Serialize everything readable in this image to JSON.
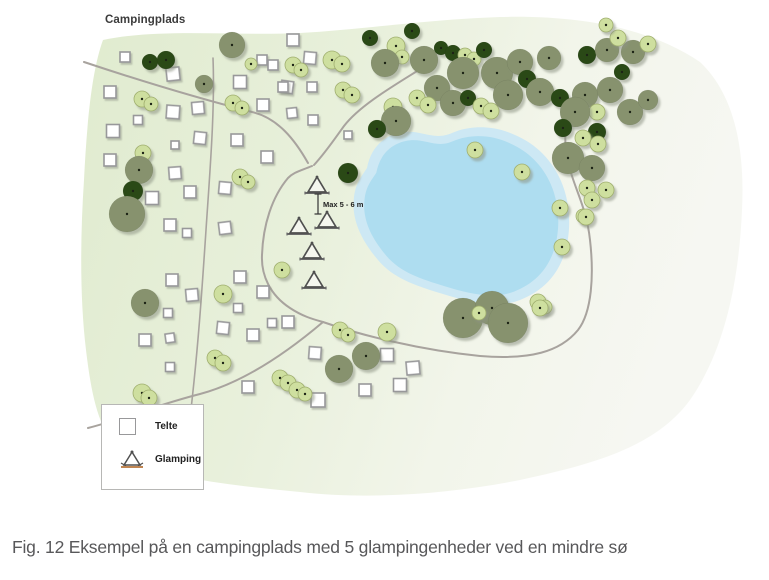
{
  "figure": {
    "map_label": "Campingplads",
    "annotation": "Max 5 - 6 m",
    "caption": "Fig. 12 Eksempel på en campingplads med 5 glampingenheder ved en mindre sø"
  },
  "legend": {
    "items": [
      {
        "symbol": "tent-square",
        "label": "Telte"
      },
      {
        "symbol": "glamping-triangle",
        "label": "Glamping"
      }
    ]
  },
  "colors": {
    "page_bg": "#ffffff",
    "terrain_green": "#e0ebcf",
    "terrain_mid": "#e8f0db",
    "terrain_pale": "#f2f5ea",
    "terrain_white": "#f6f7f2",
    "lake_outer": "#cde8f4",
    "lake_inner": "#aeddf0",
    "road": "#a8a39e",
    "tent_fill": "#ffffff",
    "tent_stroke": "#98989a",
    "tree_dark": "#2c4a17",
    "tree_olive": "#87926e",
    "tree_light": "#cedf9f",
    "tree_light_stroke": "#9fae6e",
    "tree_dot": "#1d2412",
    "glamping_stroke": "#4f4f4f",
    "glamping_base": "#6a6a6a",
    "glamping_base_legend": "#c08552",
    "dimension": "#333333",
    "shadow": "#8d9384"
  },
  "terrain": {
    "outline": "M 103,40 C 160,28 230,36 300,33 C 360,30 420,20 500,17 C 580,15 650,28 700,62 C 735,95 745,150 742,210 C 739,280 725,350 690,400 C 655,448 590,465 520,480 C 450,494 370,500 300,492 C 240,486 170,480 130,458 C 100,440 92,400 86,350 C 80,300 80,240 84,180 C 87,120 92,70 103,40 Z"
  },
  "lake": {
    "outline": "M 367,168 C 371,146 386,134 404,132 C 422,130 434,141 452,133 C 470,125 494,125 515,135 C 536,144 552,160 561,181 C 570,202 572,228 565,252 C 558,275 543,291 520,300 C 497,309 469,302 443,294 C 417,286 394,279 378,260 C 362,241 351,220 354,197 C 356,182 362,176 367,168 Z",
    "inner_scale": 0.9,
    "center": [
      460,
      216
    ]
  },
  "roads": [
    {
      "d": "M 84,62 C 150,84 205,100 252,112 C 278,118 295,140 308,163",
      "w": 2
    },
    {
      "d": "M 422,68 C 395,85 360,105 344,126 C 336,137 326,152 314,165",
      "w": 2
    },
    {
      "d": "M 312,166 C 300,171 294,172 288,178 C 272,197 263,225 262,255 C 261,275 270,295 290,308 C 302,316 312,319 323,322",
      "w": 2
    },
    {
      "d": "M 213,58 C 215,110 210,170 206,230 C 202,290 198,350 190,418",
      "w": 1.6
    },
    {
      "d": "M 88,428 C 120,420 160,404 200,394 C 245,382 290,350 323,322",
      "w": 2
    },
    {
      "d": "M 323,322 C 360,335 420,350 480,356 C 530,360 560,352 578,330 C 592,312 594,275 590,240 C 587,212 578,195 572,176 C 566,158 564,143 566,128",
      "w": 2
    }
  ],
  "tents": [
    [
      125,
      57,
      10,
      0
    ],
    [
      262,
      60,
      10,
      0
    ],
    [
      173,
      74,
      13,
      -6
    ],
    [
      240,
      82,
      13,
      0
    ],
    [
      287,
      87,
      12,
      8
    ],
    [
      110,
      92,
      12,
      0
    ],
    [
      198,
      108,
      12,
      -5
    ],
    [
      263,
      105,
      12,
      0
    ],
    [
      173,
      112,
      13,
      4
    ],
    [
      313,
      120,
      10,
      0
    ],
    [
      138,
      120,
      9,
      0
    ],
    [
      113,
      131,
      13,
      0
    ],
    [
      200,
      138,
      12,
      6
    ],
    [
      237,
      140,
      12,
      0
    ],
    [
      292,
      113,
      10,
      -6
    ],
    [
      110,
      160,
      12,
      0
    ],
    [
      267,
      157,
      12,
      0
    ],
    [
      175,
      145,
      8,
      0
    ],
    [
      175,
      173,
      12,
      -4
    ],
    [
      152,
      198,
      13,
      0
    ],
    [
      190,
      192,
      12,
      0
    ],
    [
      225,
      188,
      12,
      5
    ],
    [
      170,
      225,
      12,
      0
    ],
    [
      187,
      233,
      9,
      0
    ],
    [
      225,
      228,
      12,
      -7
    ],
    [
      293,
      40,
      12,
      0
    ],
    [
      310,
      58,
      12,
      5
    ],
    [
      273,
      65,
      10,
      0
    ],
    [
      283,
      87,
      10,
      0
    ],
    [
      312,
      87,
      10,
      0
    ],
    [
      348,
      135,
      8,
      0
    ],
    [
      172,
      280,
      12,
      0
    ],
    [
      192,
      295,
      12,
      -5
    ],
    [
      240,
      277,
      12,
      0
    ],
    [
      263,
      292,
      12,
      0
    ],
    [
      238,
      308,
      9,
      0
    ],
    [
      223,
      328,
      12,
      6
    ],
    [
      253,
      335,
      12,
      0
    ],
    [
      272,
      323,
      9,
      0
    ],
    [
      288,
      322,
      12,
      0
    ],
    [
      168,
      313,
      9,
      0
    ],
    [
      145,
      340,
      12,
      0
    ],
    [
      170,
      338,
      9,
      -8
    ],
    [
      170,
      367,
      9,
      0
    ],
    [
      248,
      387,
      12,
      0
    ],
    [
      315,
      353,
      12,
      4
    ],
    [
      365,
      390,
      12,
      0
    ],
    [
      400,
      385,
      13,
      0
    ],
    [
      413,
      368,
      13,
      -5
    ],
    [
      387,
      355,
      13,
      0
    ],
    [
      318,
      400,
      14,
      0
    ]
  ],
  "trees": [
    [
      150,
      62,
      8,
      "d"
    ],
    [
      166,
      60,
      9,
      "d"
    ],
    [
      232,
      45,
      13,
      "o"
    ],
    [
      251,
      64,
      6,
      "l"
    ],
    [
      204,
      84,
      9,
      "o"
    ],
    [
      142,
      99,
      8,
      "l"
    ],
    [
      151,
      104,
      7,
      "l"
    ],
    [
      233,
      103,
      8,
      "l"
    ],
    [
      242,
      108,
      7,
      "l"
    ],
    [
      293,
      65,
      8,
      "l"
    ],
    [
      301,
      70,
      7,
      "l"
    ],
    [
      143,
      153,
      8,
      "l"
    ],
    [
      139,
      170,
      14,
      "o"
    ],
    [
      133,
      191,
      10,
      "d"
    ],
    [
      127,
      214,
      18,
      "o"
    ],
    [
      145,
      303,
      14,
      "o"
    ],
    [
      223,
      294,
      9,
      "l"
    ],
    [
      282,
      270,
      8,
      "l"
    ],
    [
      240,
      177,
      8,
      "l"
    ],
    [
      248,
      182,
      7,
      "l"
    ],
    [
      215,
      358,
      8,
      "l"
    ],
    [
      223,
      363,
      8,
      "l"
    ],
    [
      280,
      378,
      8,
      "l"
    ],
    [
      288,
      383,
      8,
      "l"
    ],
    [
      297,
      390,
      8,
      "l"
    ],
    [
      305,
      394,
      7,
      "l"
    ],
    [
      142,
      393,
      9,
      "l"
    ],
    [
      149,
      398,
      8,
      "l"
    ],
    [
      340,
      330,
      8,
      "l"
    ],
    [
      348,
      335,
      7,
      "l"
    ],
    [
      387,
      332,
      9,
      "l"
    ],
    [
      339,
      369,
      14,
      "o"
    ],
    [
      366,
      356,
      14,
      "o"
    ],
    [
      393,
      107,
      9,
      "l"
    ],
    [
      396,
      121,
      15,
      "o"
    ],
    [
      377,
      129,
      9,
      "d"
    ],
    [
      348,
      173,
      10,
      "d"
    ],
    [
      475,
      150,
      8,
      "l"
    ],
    [
      522,
      172,
      8,
      "l"
    ],
    [
      560,
      208,
      8,
      "l"
    ],
    [
      583,
      216,
      7,
      "l"
    ],
    [
      562,
      247,
      8,
      "l"
    ],
    [
      538,
      302,
      8,
      "l"
    ],
    [
      545,
      307,
      7,
      "l"
    ],
    [
      463,
      318,
      20,
      "o"
    ],
    [
      492,
      308,
      17,
      "o"
    ],
    [
      508,
      323,
      20,
      "o"
    ],
    [
      479,
      313,
      7,
      "l"
    ],
    [
      540,
      308,
      8,
      "l"
    ],
    [
      332,
      60,
      9,
      "l"
    ],
    [
      342,
      64,
      8,
      "l"
    ],
    [
      343,
      90,
      8,
      "l"
    ],
    [
      352,
      95,
      8,
      "l"
    ],
    [
      370,
      38,
      8,
      "d"
    ],
    [
      412,
      31,
      8,
      "d"
    ],
    [
      396,
      46,
      9,
      "l"
    ],
    [
      402,
      57,
      7,
      "l"
    ],
    [
      385,
      63,
      14,
      "o"
    ],
    [
      424,
      60,
      14,
      "o"
    ],
    [
      441,
      48,
      7,
      "d"
    ],
    [
      453,
      53,
      8,
      "d"
    ],
    [
      465,
      55,
      7,
      "l"
    ],
    [
      474,
      59,
      7,
      "l"
    ],
    [
      484,
      50,
      8,
      "d"
    ],
    [
      497,
      73,
      16,
      "o"
    ],
    [
      520,
      62,
      13,
      "o"
    ],
    [
      527,
      79,
      9,
      "d"
    ],
    [
      549,
      58,
      12,
      "o"
    ],
    [
      587,
      55,
      9,
      "d"
    ],
    [
      607,
      50,
      12,
      "o"
    ],
    [
      633,
      52,
      12,
      "o"
    ],
    [
      618,
      38,
      8,
      "l"
    ],
    [
      606,
      25,
      7,
      "l"
    ],
    [
      648,
      44,
      8,
      "l"
    ],
    [
      463,
      73,
      16,
      "o"
    ],
    [
      437,
      88,
      13,
      "o"
    ],
    [
      417,
      98,
      8,
      "l"
    ],
    [
      428,
      105,
      8,
      "l"
    ],
    [
      453,
      103,
      13,
      "o"
    ],
    [
      468,
      98,
      8,
      "d"
    ],
    [
      481,
      106,
      8,
      "l"
    ],
    [
      491,
      111,
      8,
      "l"
    ],
    [
      508,
      95,
      15,
      "o"
    ],
    [
      540,
      92,
      14,
      "o"
    ],
    [
      560,
      98,
      9,
      "d"
    ],
    [
      585,
      95,
      13,
      "o"
    ],
    [
      610,
      90,
      13,
      "o"
    ],
    [
      597,
      112,
      8,
      "l"
    ],
    [
      630,
      112,
      13,
      "o"
    ],
    [
      648,
      100,
      10,
      "o"
    ],
    [
      622,
      72,
      8,
      "d"
    ],
    [
      575,
      112,
      15,
      "o"
    ],
    [
      563,
      128,
      9,
      "d"
    ],
    [
      597,
      132,
      9,
      "d"
    ],
    [
      583,
      138,
      8,
      "l"
    ],
    [
      598,
      144,
      8,
      "l"
    ],
    [
      568,
      158,
      16,
      "o"
    ],
    [
      592,
      168,
      13,
      "o"
    ],
    [
      587,
      188,
      8,
      "l"
    ],
    [
      606,
      190,
      8,
      "l"
    ],
    [
      592,
      200,
      8,
      "l"
    ],
    [
      586,
      217,
      8,
      "l"
    ]
  ],
  "glamping_units": [
    [
      317,
      186
    ],
    [
      327,
      221
    ],
    [
      299,
      227
    ],
    [
      312,
      252
    ],
    [
      314,
      281
    ]
  ],
  "dimension": {
    "x": 318,
    "y1": 194,
    "y2": 214,
    "label_x": 323,
    "label_y": 207
  }
}
